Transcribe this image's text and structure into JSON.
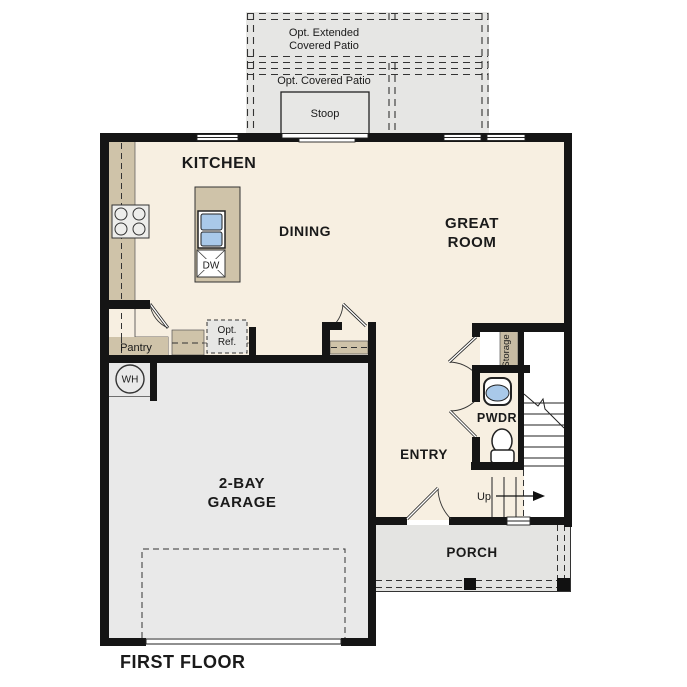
{
  "figure_label": "FIRST FLOOR",
  "colors": {
    "floor": "#f7efe1",
    "garage": "#e9e9e9",
    "porch": "#e4e4e2",
    "patio": "#e6e6e4",
    "stoop": "#e7e7e5",
    "counter": "#cfc3a9",
    "storage_strip": "#c7bba3",
    "sink_blue": "#a9c9e9",
    "appliance": "#ededeb",
    "opt_ref_fill": "#e7e7e5",
    "wall": "#151515"
  },
  "rooms": {
    "kitchen": {
      "label": "KITCHEN"
    },
    "dining": {
      "label": "DINING"
    },
    "great_room": {
      "label_line1": "GREAT",
      "label_line2": "ROOM"
    },
    "garage": {
      "label_line1": "2-BAY",
      "label_line2": "GARAGE"
    },
    "entry": {
      "label": "ENTRY"
    },
    "powder": {
      "label": "PWDR"
    },
    "porch": {
      "label": "PORCH"
    },
    "pantry": {
      "label": "Pantry"
    },
    "storage": {
      "label": "Storage"
    },
    "stoop": {
      "label": "Stoop"
    },
    "covered_patio": {
      "label": "Opt. Covered Patio"
    },
    "extended_patio": {
      "label_line1": "Opt. Extended",
      "label_line2": "Covered Patio"
    }
  },
  "fixtures": {
    "water_heater_label": "WH",
    "dishwasher_label": "DW",
    "opt_ref_line1": "Opt.",
    "opt_ref_line2": "Ref.",
    "stairs_up_label": "Up"
  }
}
